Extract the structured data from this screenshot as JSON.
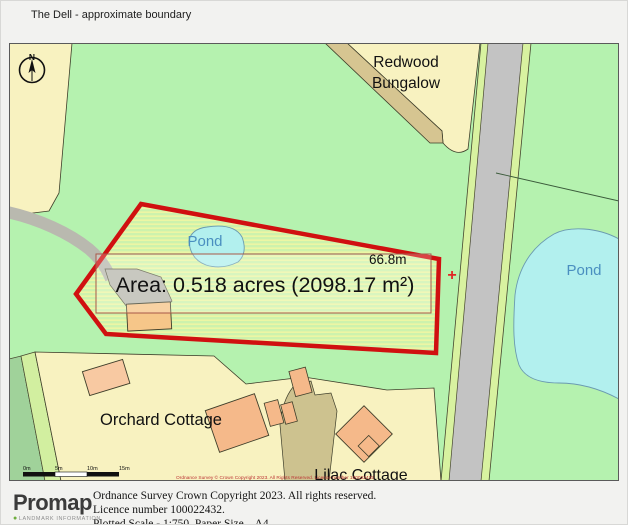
{
  "window": {
    "title": "The Dell - approximate boundary"
  },
  "map": {
    "north_label": "N",
    "parcels": {
      "redwood_line1": "Redwood",
      "redwood_line2": "Bungalow",
      "orchard": "Orchard Cottage",
      "lilac": "Lilac Cottage"
    },
    "water": {
      "pond_small": "Pond",
      "pond_large": "Pond"
    },
    "boundary": {
      "area_label": "Area: 0.518 acres (2098.17 m²)",
      "measurement": "66.8m",
      "acres": 0.518,
      "square_meters": 2098.17,
      "length_m": 66.8
    },
    "marker": "+",
    "os_credit": "Ordnance Survey © Crown Copyright 2023. All Rights Reserved. Licence number 100022432",
    "scale_bar": {
      "ticks": [
        "0m",
        "5m",
        "10m",
        "15m"
      ]
    },
    "colors": {
      "field_green": "#b5f2af",
      "parcel_cream": "#f8f2c0",
      "road_gray": "#c3c3c3",
      "verge_green": "#d8f2a0",
      "track_tan": "#d6c591",
      "pond_cyan": "#b2f0ee",
      "building_orange": "#f5b98a",
      "boundary_red": "#d01010"
    }
  },
  "footer": {
    "logo_text": "Promap",
    "logo_subtext": "LANDMARK INFORMATION",
    "copyright_line1": "Ordnance Survey Crown Copyright 2023. All rights reserved.",
    "copyright_line2": "Licence number 100022432.",
    "copyright_line3": "Plotted Scale - 1:750. Paper Size – A4"
  }
}
